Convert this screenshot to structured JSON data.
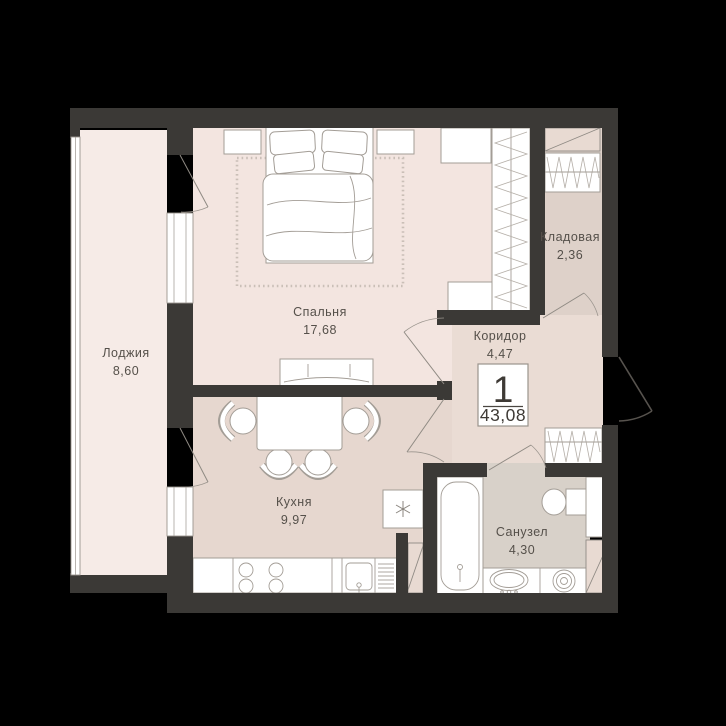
{
  "plan": {
    "summary": {
      "rooms_count": "1",
      "total_area": "43,08"
    },
    "rooms": [
      {
        "id": "bedroom",
        "name": "Спальня",
        "area": "17,68"
      },
      {
        "id": "loggia",
        "name": "Лоджия",
        "area": "8,60"
      },
      {
        "id": "storage",
        "name": "Кладовая",
        "area": "2,36"
      },
      {
        "id": "corridor",
        "name": "Коридор",
        "area": "4,47"
      },
      {
        "id": "kitchen",
        "name": "Кухня",
        "area": "9,97"
      },
      {
        "id": "bathroom",
        "name": "Санузел",
        "area": "4,30"
      }
    ]
  },
  "theme": {
    "bg": "#000000",
    "wall": "#3b3936",
    "loggia": "#f6ebe7",
    "bedroom": "#f3e5e0",
    "kitchen": "#e6d7cf",
    "corridor": "#eadcd4",
    "storage": "#ded1c9",
    "bathroom": "#d8d1c9",
    "duct": "#e8dad2",
    "furniture_stroke": "#a39d96",
    "text": "#55504a"
  }
}
